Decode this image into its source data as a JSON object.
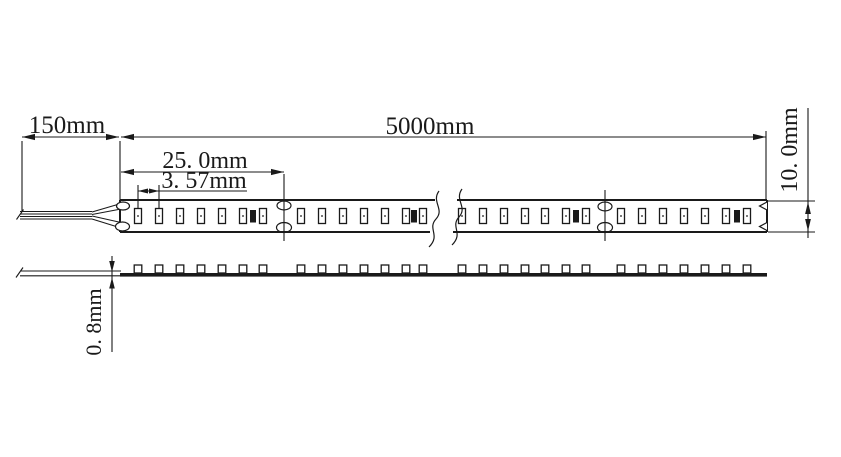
{
  "drawing": {
    "title": "led-strip-dimension-drawing",
    "background_color": "#ffffff",
    "line_color": "#1a1a1a",
    "labels": {
      "lead_length": "150mm",
      "total_length": "5000mm",
      "cut_unit_length": "25. 0mm",
      "led_pitch": "3. 57mm",
      "strip_width": "10. 0mm",
      "strip_thickness": "0. 8mm"
    },
    "strip": {
      "leds_per_cut_unit": 7,
      "led_sections_x": [
        [
          138,
          159,
          180,
          201,
          222,
          243,
          263
        ],
        [
          301,
          322,
          343,
          364,
          385,
          406,
          423
        ],
        [
          462,
          483,
          504,
          525,
          545,
          566,
          586
        ],
        [
          621,
          642,
          663,
          684,
          705,
          726,
          747
        ]
      ],
      "resistor_x": [
        253,
        414,
        576,
        737
      ],
      "cut_mark_x": [
        284,
        605
      ],
      "top_view": {
        "x1": 120,
        "x2": 767,
        "y1": 200,
        "y2": 232
      },
      "side_view": {
        "x1": 120,
        "x2": 767,
        "y_top": 273,
        "thickness": 3.6
      },
      "break_gap": {
        "x1": 434,
        "x2": 456
      }
    }
  }
}
